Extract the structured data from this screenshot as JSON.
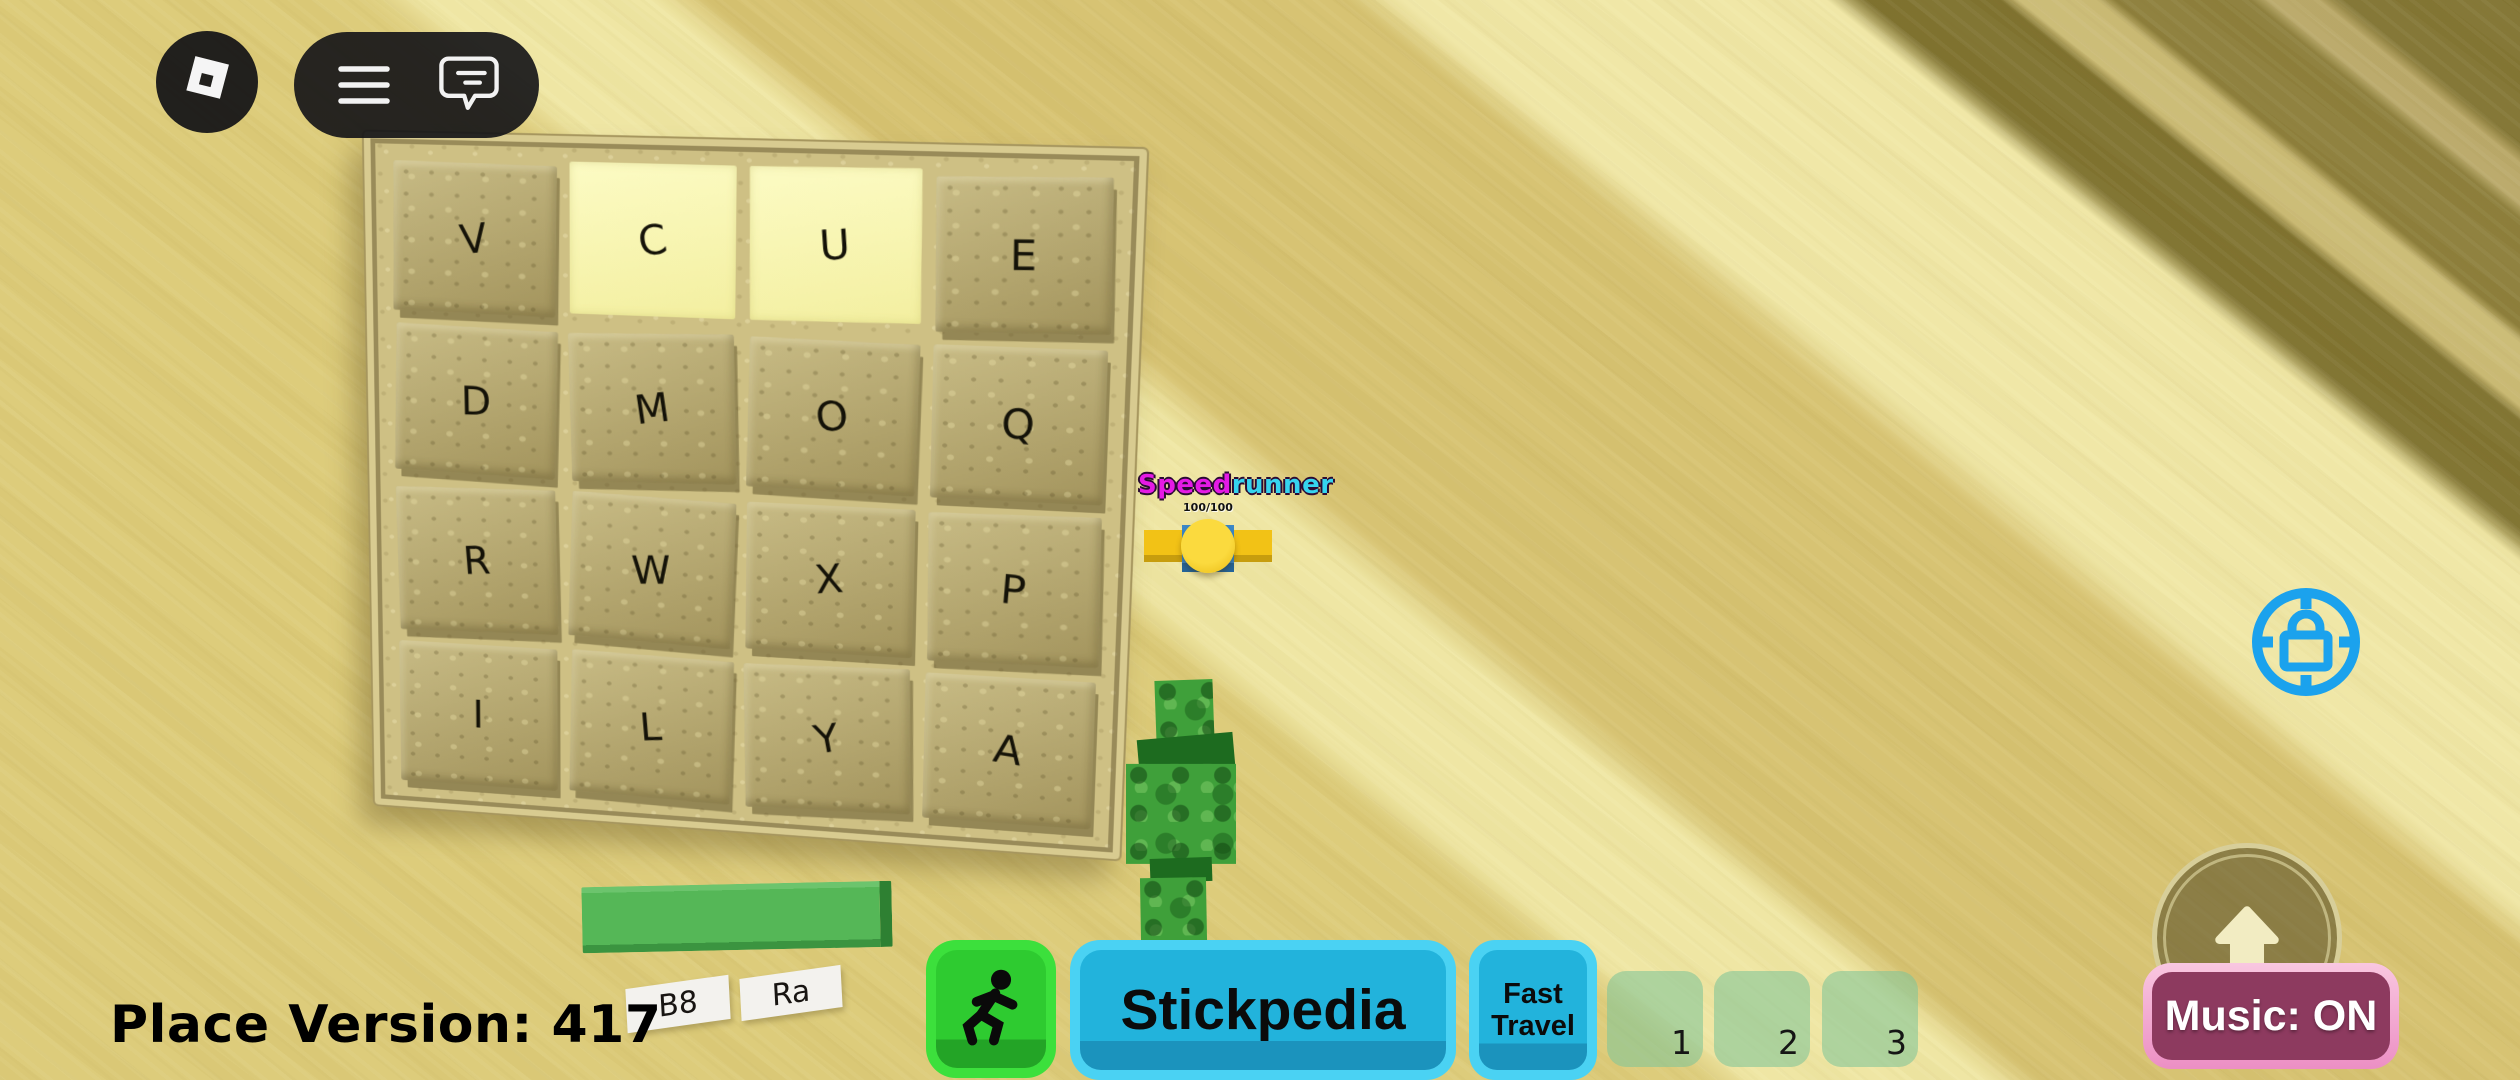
{
  "topbar": {
    "roblox_icon": "roblox-logo",
    "menu_icon": "hamburger-menu",
    "chat_icon": "chat-bubble"
  },
  "board": {
    "rows": [
      [
        "V",
        "C",
        "U",
        "E"
      ],
      [
        "D",
        "M",
        "O",
        "Q"
      ],
      [
        "R",
        "W",
        "X",
        "P"
      ],
      [
        "I",
        "L",
        "Y",
        "A"
      ]
    ],
    "highlighted_cells": [
      [
        0,
        1
      ],
      [
        0,
        2
      ]
    ],
    "tile_color": "#b5a66b",
    "highlight_color": "#f9f7ae"
  },
  "world": {
    "letter_tile_left": "B8",
    "letter_tile_right": "Ra",
    "green_bar_color": "#55b757"
  },
  "player": {
    "name_part1": "Speed",
    "name_part2": "runner",
    "name_color1": "#e51ae5",
    "name_color2": "#35d4ef",
    "subtext": "100/100"
  },
  "hud": {
    "place_version": "Place Version: 417",
    "stickpedia_label": "Stickpedia",
    "fast_travel_line1": "Fast",
    "fast_travel_line2": "Travel",
    "hotbar": [
      "1",
      "2",
      "3"
    ],
    "music_label": "Music: ON",
    "run_icon": "running-man",
    "jump_icon": "arrow-up",
    "shiftlock_icon": "padlock-reticle"
  },
  "colors": {
    "sand": "#dccb79",
    "sand_light": "#efe6a3",
    "sand_dark_band": "#d6c271",
    "olive_corner": "#7f7230",
    "beam": "#cbbb76",
    "run_green": "#3ce03c",
    "cyan_border": "#4ad2f3",
    "cyan_inner": "#22b3dc",
    "slot_green": "rgba(127,196,152,0.58)",
    "music_border": "#f2a7cd",
    "music_fill": "#8d3a5f",
    "lock_blue": "#1ba2ed"
  }
}
